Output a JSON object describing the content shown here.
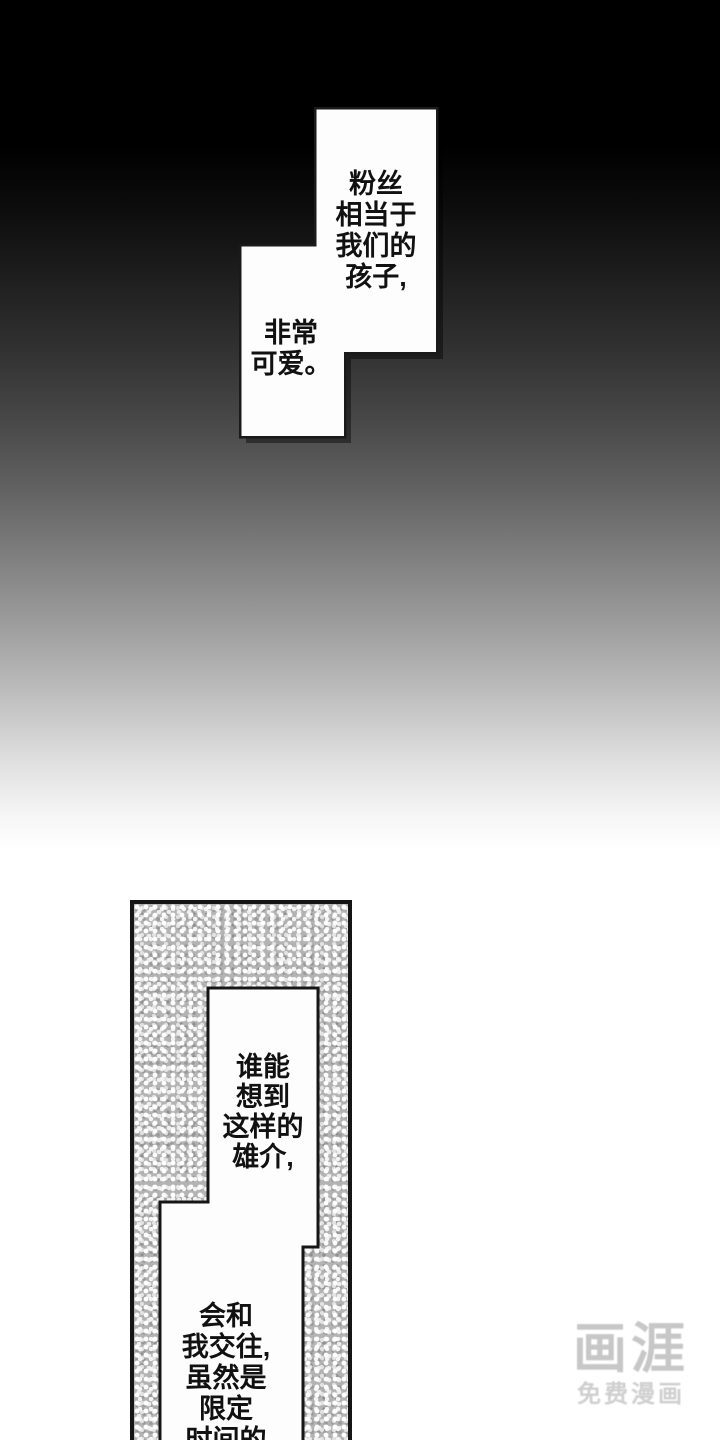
{
  "page": {
    "type": "manga-page"
  },
  "bubbles": {
    "fans": {
      "lines": [
        "粉丝",
        "相当于",
        "我们的",
        "孩子,"
      ]
    },
    "cute": {
      "lines": [
        "非常",
        "可爱。"
      ]
    },
    "who": {
      "lines": [
        "谁能",
        "想到",
        "这样的",
        "雄介,"
      ]
    },
    "date": {
      "lines": [
        "会和",
        "我交往,",
        "虽然是",
        "限定",
        "时间的"
      ]
    }
  },
  "watermark": {
    "logo": "画涯",
    "subtitle": "免费漫画"
  },
  "colors": {
    "ink": "#111111",
    "bubble_fill": "#fdfdfd",
    "panel_texture_base": "#b3b3b3",
    "watermark_gray": "#c7c7c7"
  }
}
